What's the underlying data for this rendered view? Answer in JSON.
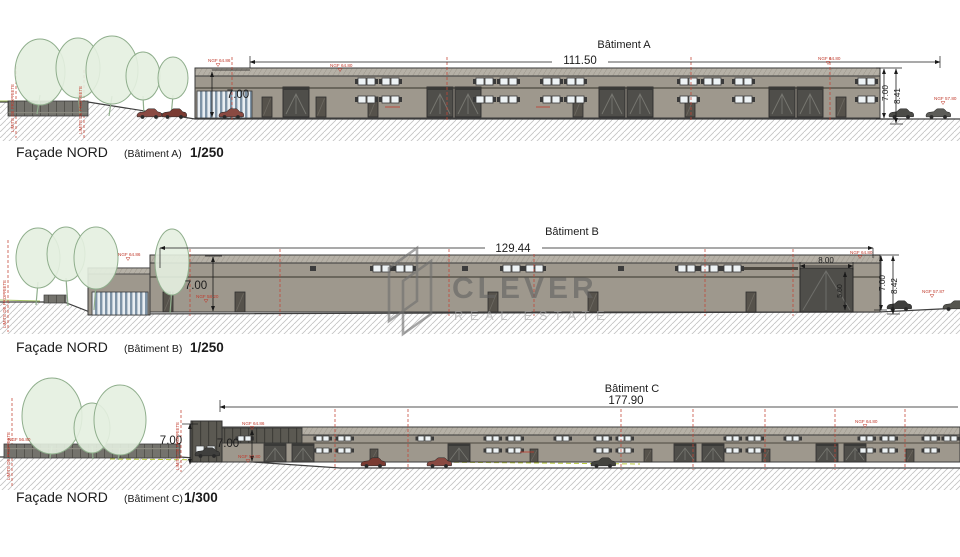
{
  "watermark": {
    "brand": "CLEVER",
    "tagline": "REAL ESTATE"
  },
  "sections": [
    {
      "key": "batiment-a",
      "title": "Bâtiment A",
      "facade": "Façade NORD",
      "building_ref": "(Bâtiment A)",
      "scale": "1/250",
      "dim_width": "111.50",
      "dim_eave_left": "7.00",
      "dim_eave_right": "7.00",
      "dim_total_right": "8.41",
      "lvl_roof_left": "NGF 64.86",
      "lvl_roof_mid": "NGF 64.80",
      "lvl_roof_right": "NGF 64.80",
      "lvl_ground_right": "NGF 57.80",
      "property_line": "LIMITE DE PROPRIETE"
    },
    {
      "key": "batiment-b",
      "title": "Bâtiment B",
      "facade": "Façade NORD",
      "building_ref": "(Bâtiment B)",
      "scale": "1/250",
      "dim_width": "129.44",
      "dim_eave_left": "7.00",
      "dim_door_width": "8.00",
      "dim_door_height": "5.60",
      "dim_eave_right": "7.00",
      "dim_total_right": "8.42",
      "lvl_roof_left": "NGF 64.86",
      "lvl_roof_right": "NGF 64.80",
      "lvl_ground_mid": "NGF 58.20",
      "lvl_ground_right": "NGF 57.87",
      "property_line": "LIMITE DE PROPRIETE"
    },
    {
      "key": "batiment-c",
      "title": "Bâtiment C",
      "facade": "Façade NORD",
      "building_ref": "(Bâtiment C)",
      "scale": "1/300",
      "dim_width": "177.90",
      "dim_eave_left": "7.00",
      "dim_eave_left2": "7.00",
      "lvl_roof_left": "NGF 64.86",
      "lvl_roof_right": "NGF 64.80",
      "lvl_ground_left": "NGF 56.80",
      "lvl_ground_mid": "NGF 57.80",
      "property_line": "LIMITE DE PROPRIETE"
    }
  ]
}
